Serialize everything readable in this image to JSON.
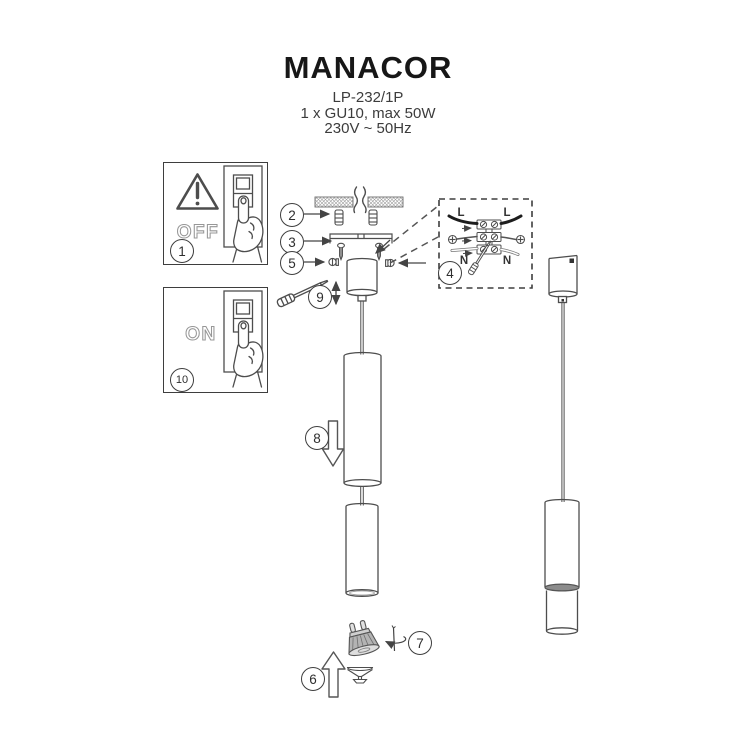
{
  "header": {
    "title": "MANACOR",
    "model": "LP-232/1P",
    "bulb_spec": "1 x GU10, max 50W",
    "power_spec": "230V ~ 50Hz"
  },
  "panels": {
    "off": {
      "step": "1",
      "label": "OFF"
    },
    "on": {
      "step": "10",
      "label": "ON"
    }
  },
  "steps": {
    "anchors": "2",
    "bracket": "3",
    "wiring": "4",
    "set_screw": "5",
    "bulb_insert": "6",
    "bulb_rotate": "7",
    "shade_slide": "8",
    "cable_adjust": "9"
  },
  "wiring_labels": {
    "live_left": "L",
    "live_right": "L",
    "neutral_left": "N",
    "neutral_right": "N"
  },
  "colors": {
    "line": "#4d4d4d",
    "wire_black": "#1d1d1d",
    "ring_gray": "#8c8c8c"
  }
}
